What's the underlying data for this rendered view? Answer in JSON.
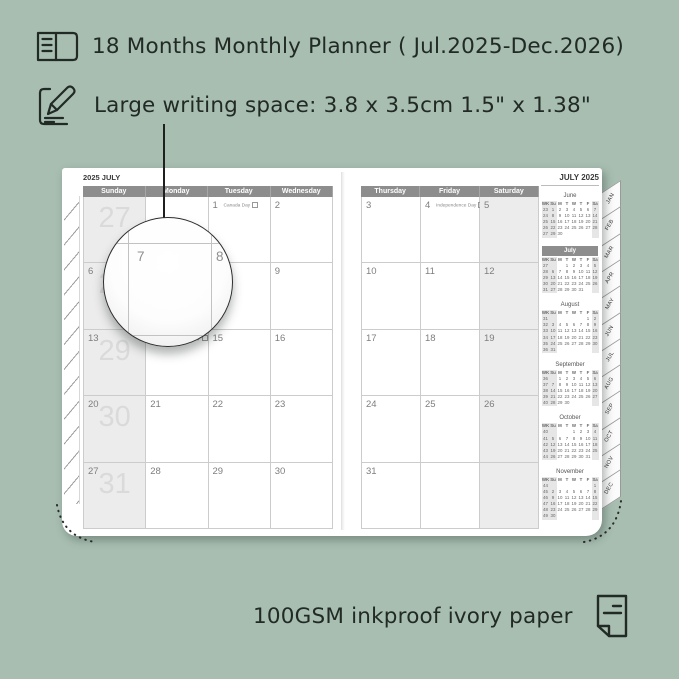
{
  "colors": {
    "background": "#a7beb1",
    "ink": "#222a26",
    "page": "#ffffff",
    "header_bar": "#8d8d8d",
    "shaded_column": "#ececec",
    "week_number": "#dadada"
  },
  "annotations": {
    "feature_1": "18 Months Monthly Planner ( Jul.2025-Dec.2026)",
    "feature_2": "Large writing space: 3.8 x 3.5cm 1.5\" x 1.38\"",
    "feature_3": "100GSM inkproof ivory paper"
  },
  "magnifier": {
    "day_left": "7",
    "day_right": "8"
  },
  "planner": {
    "left_page": {
      "title": "2025 JULY",
      "day_headers": [
        "Sunday",
        "Monday",
        "Tuesday",
        "Wednesday"
      ],
      "weeks": [
        {
          "week_number": "27",
          "cells": [
            {
              "d": ""
            },
            {
              "d": ""
            },
            {
              "d": "1",
              "holiday": "Canada Day"
            },
            {
              "d": "2"
            }
          ]
        },
        {
          "week_number": "28",
          "cells": [
            {
              "d": "6"
            },
            {
              "d": "7"
            },
            {
              "d": "8"
            },
            {
              "d": "9"
            }
          ]
        },
        {
          "week_number": "29",
          "cells": [
            {
              "d": "13"
            },
            {
              "d": "14",
              "holiday": "Orangemen's Day"
            },
            {
              "d": "15"
            },
            {
              "d": "16"
            }
          ]
        },
        {
          "week_number": "30",
          "cells": [
            {
              "d": "20"
            },
            {
              "d": "21"
            },
            {
              "d": "22"
            },
            {
              "d": "23"
            }
          ]
        },
        {
          "week_number": "31",
          "cells": [
            {
              "d": "27"
            },
            {
              "d": "28"
            },
            {
              "d": "29"
            },
            {
              "d": "30"
            }
          ]
        }
      ]
    },
    "right_page": {
      "title": "JULY 2025",
      "day_headers": [
        "Thursday",
        "Friday",
        "Saturday"
      ],
      "weeks": [
        {
          "cells": [
            {
              "d": "3"
            },
            {
              "d": "4",
              "holiday": "Independence Day"
            },
            {
              "d": "5"
            }
          ]
        },
        {
          "cells": [
            {
              "d": "10"
            },
            {
              "d": "11"
            },
            {
              "d": "12"
            }
          ]
        },
        {
          "cells": [
            {
              "d": "17"
            },
            {
              "d": "18"
            },
            {
              "d": "19"
            }
          ]
        },
        {
          "cells": [
            {
              "d": "24"
            },
            {
              "d": "25"
            },
            {
              "d": "26"
            }
          ]
        },
        {
          "cells": [
            {
              "d": "31"
            },
            {
              "d": ""
            },
            {
              "d": ""
            }
          ]
        }
      ]
    },
    "mini_calendars": [
      {
        "name": "June",
        "highlight": false,
        "header": [
          "WK",
          "Su",
          "M",
          "T",
          "W",
          "T",
          "F",
          "Sa"
        ],
        "rows": [
          [
            "23",
            "1",
            "2",
            "3",
            "4",
            "5",
            "6",
            "7"
          ],
          [
            "24",
            "8",
            "9",
            "10",
            "11",
            "12",
            "13",
            "14"
          ],
          [
            "25",
            "15",
            "16",
            "17",
            "18",
            "19",
            "20",
            "21"
          ],
          [
            "26",
            "22",
            "23",
            "24",
            "25",
            "26",
            "27",
            "28"
          ],
          [
            "27",
            "29",
            "30",
            "",
            "",
            "",
            "",
            ""
          ]
        ]
      },
      {
        "name": "July",
        "highlight": true,
        "header": [
          "WK",
          "Su",
          "M",
          "T",
          "W",
          "T",
          "F",
          "Sa"
        ],
        "rows": [
          [
            "27",
            "",
            "",
            "1",
            "2",
            "3",
            "4",
            "5"
          ],
          [
            "28",
            "6",
            "7",
            "8",
            "9",
            "10",
            "11",
            "12"
          ],
          [
            "29",
            "13",
            "14",
            "15",
            "16",
            "17",
            "18",
            "19"
          ],
          [
            "30",
            "20",
            "21",
            "22",
            "23",
            "24",
            "25",
            "26"
          ],
          [
            "31",
            "27",
            "28",
            "29",
            "30",
            "31",
            "",
            ""
          ]
        ]
      },
      {
        "name": "August",
        "highlight": false,
        "header": [
          "WK",
          "Su",
          "M",
          "T",
          "W",
          "T",
          "F",
          "Sa"
        ],
        "rows": [
          [
            "31",
            "",
            "",
            "",
            "",
            "",
            "1",
            "2"
          ],
          [
            "32",
            "3",
            "4",
            "5",
            "6",
            "7",
            "8",
            "9"
          ],
          [
            "33",
            "10",
            "11",
            "12",
            "13",
            "14",
            "15",
            "16"
          ],
          [
            "34",
            "17",
            "18",
            "19",
            "20",
            "21",
            "22",
            "23"
          ],
          [
            "35",
            "24",
            "25",
            "26",
            "27",
            "28",
            "29",
            "30"
          ],
          [
            "36",
            "31",
            "",
            "",
            "",
            "",
            "",
            ""
          ]
        ]
      },
      {
        "name": "September",
        "highlight": false,
        "header": [
          "WK",
          "Su",
          "M",
          "T",
          "W",
          "T",
          "F",
          "Sa"
        ],
        "rows": [
          [
            "36",
            "",
            "1",
            "2",
            "3",
            "4",
            "5",
            "6"
          ],
          [
            "37",
            "7",
            "8",
            "9",
            "10",
            "11",
            "12",
            "13"
          ],
          [
            "38",
            "14",
            "15",
            "16",
            "17",
            "18",
            "19",
            "20"
          ],
          [
            "39",
            "21",
            "22",
            "23",
            "24",
            "25",
            "26",
            "27"
          ],
          [
            "40",
            "28",
            "29",
            "30",
            "",
            "",
            "",
            ""
          ]
        ]
      },
      {
        "name": "October",
        "highlight": false,
        "header": [
          "WK",
          "Su",
          "M",
          "T",
          "W",
          "T",
          "F",
          "Sa"
        ],
        "rows": [
          [
            "40",
            "",
            "",
            "",
            "1",
            "2",
            "3",
            "4"
          ],
          [
            "41",
            "5",
            "6",
            "7",
            "8",
            "9",
            "10",
            "11"
          ],
          [
            "42",
            "12",
            "13",
            "14",
            "15",
            "16",
            "17",
            "18"
          ],
          [
            "43",
            "19",
            "20",
            "21",
            "22",
            "23",
            "24",
            "25"
          ],
          [
            "44",
            "26",
            "27",
            "28",
            "29",
            "30",
            "31",
            ""
          ]
        ]
      },
      {
        "name": "November",
        "highlight": false,
        "header": [
          "WK",
          "Su",
          "M",
          "T",
          "W",
          "T",
          "F",
          "Sa"
        ],
        "rows": [
          [
            "44",
            "",
            "",
            "",
            "",
            "",
            "",
            "1"
          ],
          [
            "45",
            "2",
            "3",
            "4",
            "5",
            "6",
            "7",
            "8"
          ],
          [
            "46",
            "9",
            "10",
            "11",
            "12",
            "13",
            "14",
            "15"
          ],
          [
            "47",
            "16",
            "17",
            "18",
            "19",
            "20",
            "21",
            "22"
          ],
          [
            "48",
            "23",
            "24",
            "25",
            "26",
            "27",
            "28",
            "29"
          ],
          [
            "49",
            "30",
            "",
            "",
            "",
            "",
            "",
            ""
          ]
        ]
      }
    ],
    "month_tabs": [
      "JAN",
      "FEB",
      "MAR",
      "APR",
      "MAY",
      "JUN",
      "JUL",
      "AUG",
      "SEP",
      "OCT",
      "NOV",
      "DEC"
    ]
  }
}
